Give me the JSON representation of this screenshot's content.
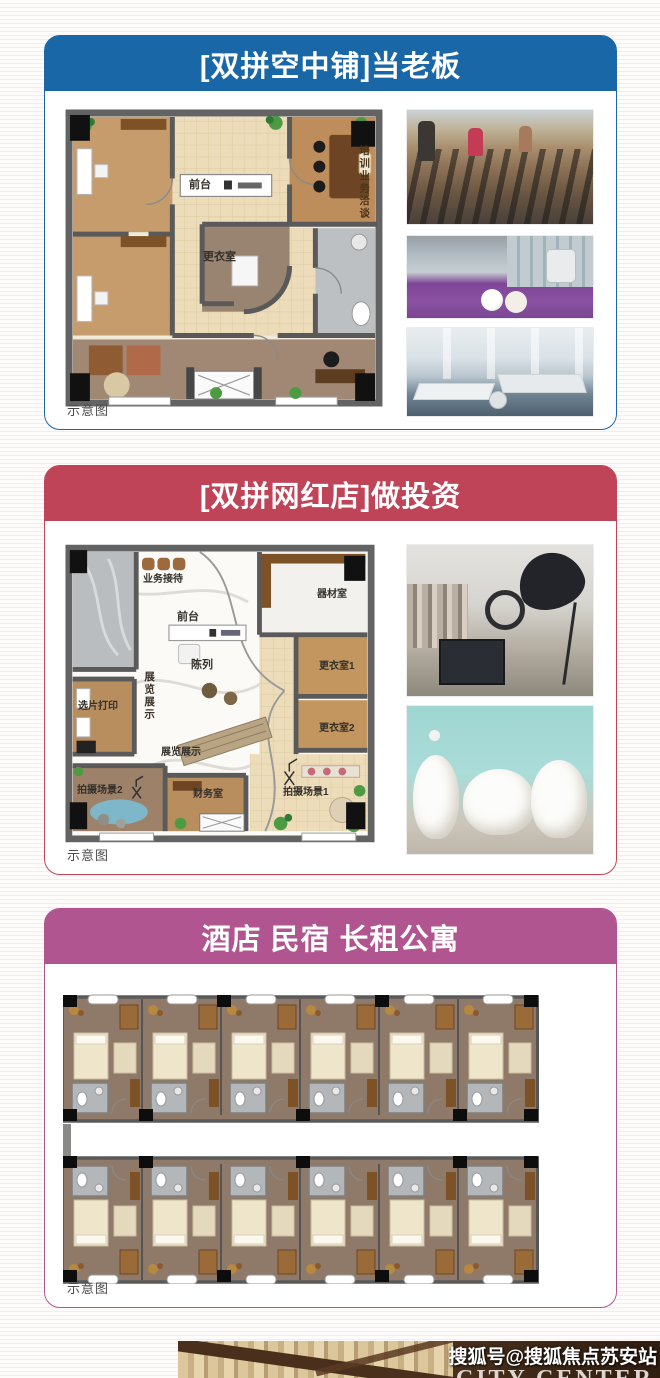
{
  "page": {
    "watermark": "搜狐号@搜狐焦点苏安站"
  },
  "bottom_photo": {
    "overlay_text": "CITY CENTER"
  },
  "cards": [
    {
      "title": "[双拼空中铺]当老板",
      "accent": "#1a67a8",
      "caption": "示意图",
      "plan_labels": {
        "front_desk": "前台",
        "changing_room": "更衣室",
        "training_vertical": "培训业务洽谈"
      },
      "photos": [
        {
          "name": "gym-treadmills"
        },
        {
          "name": "spa-massage-room"
        },
        {
          "name": "open-plan-office"
        }
      ]
    },
    {
      "title": "[双拼网红店]做投资",
      "accent": "#c04458",
      "caption": "示意图",
      "plan_labels": {
        "business_reception": "业务接待",
        "front_desk": "前台",
        "equipment_room": "器材室",
        "display": "陈列",
        "exhibition_vertical": "展览展示",
        "photo_selection_print": "选片打印",
        "changing_room_1": "更衣室1",
        "changing_room_2": "更衣室2",
        "exhibition": "展览展示",
        "finance_office": "财务室",
        "shoot_scene_2": "拍摄场景2",
        "shoot_scene_1": "拍摄场景1"
      },
      "photos": [
        {
          "name": "photo-studio"
        },
        {
          "name": "wedding-dress-rack"
        }
      ]
    },
    {
      "title": "酒店 民宿 长租公寓",
      "accent": "#b05590",
      "caption": "示意图"
    }
  ]
}
